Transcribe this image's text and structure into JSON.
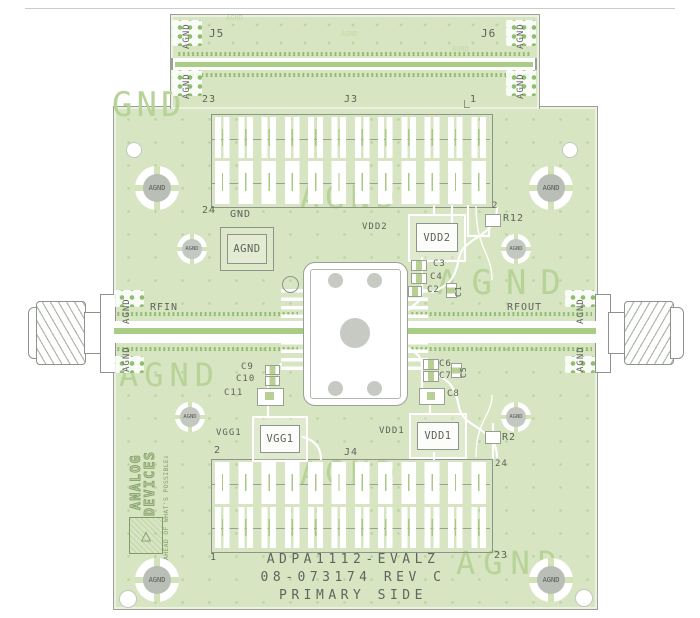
{
  "labels": {
    "agnd": "AGND",
    "gnd": "GND",
    "rfin": "RFIN",
    "rfout": "RFOUT",
    "j3": "J3",
    "j4": "J4",
    "j5": "J5",
    "j6": "J6",
    "r2": "R2",
    "r12": "R12",
    "c1": "C1",
    "c2": "C2",
    "c3": "C3",
    "c4": "C4",
    "c5": "C5",
    "c6": "C6",
    "c7": "C7",
    "c8": "C8",
    "c9": "C9",
    "c10": "C10",
    "c11": "C11",
    "vdd1": "VDD1",
    "vdd2": "VDD2",
    "vgg1": "VGG1"
  },
  "j3_pins": {
    "top_left": "23",
    "top_right": "1",
    "bottom_left": "24",
    "bottom_right": "2"
  },
  "j4_pins": {
    "top_left": "2",
    "top_right": "24",
    "bottom_left": "1",
    "bottom_right": "23"
  },
  "title": {
    "part": "ADPA1112-EVALZ",
    "doc": "08-073174 REV C",
    "side": "PRIMARY SIDE"
  },
  "logo": {
    "name_line1": "ANALOG",
    "name_line2": "DEVICES",
    "tagline": "AHEAD OF WHAT'S POSSIBLE™",
    "mark": "△"
  },
  "watermark": {
    "agnd": "AGND",
    "gnd": "GND"
  },
  "colors": {
    "board_green": "#d7e5c2",
    "silkscreen_gray": "#5d635a",
    "watermark_green": "#b7d397",
    "pad_green": "#8fbf6e",
    "trace_white": "#ffffff",
    "outline_gray": "#9aa095"
  }
}
